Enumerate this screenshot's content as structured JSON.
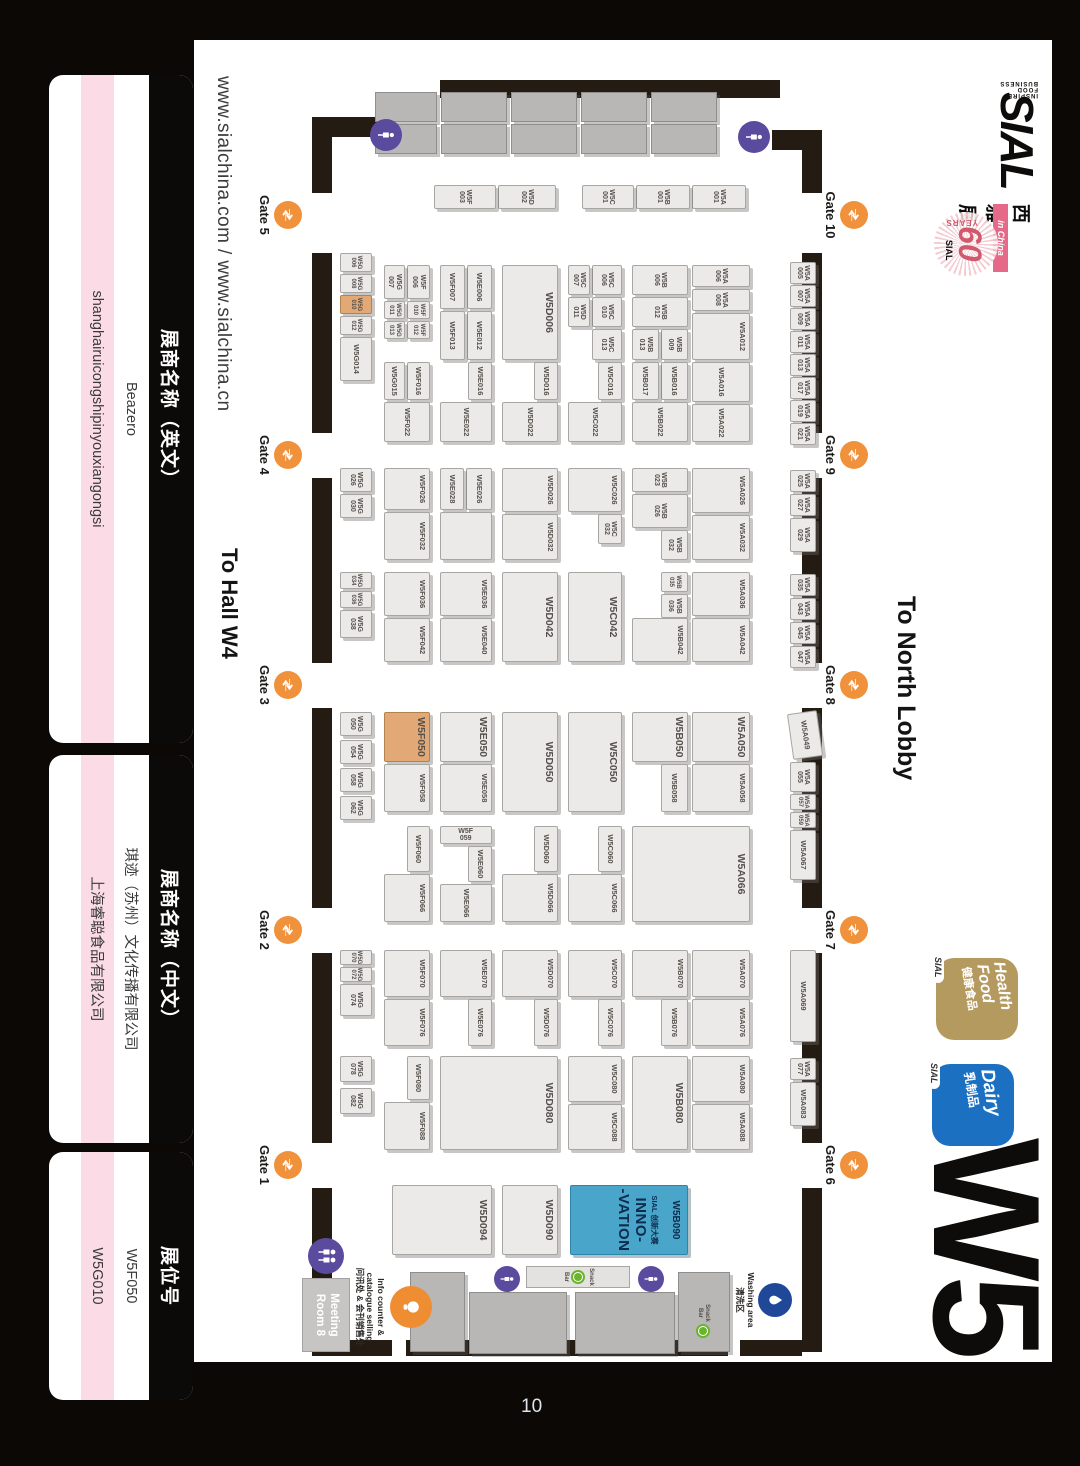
{
  "page": {
    "number": "10"
  },
  "header": {
    "urls": "www.sialchina.com / www.sialchina.cn",
    "to_hall": "To Hall W4",
    "to_lobby": "To North Lobby",
    "hall_id": "W5"
  },
  "logo": {
    "word": "SIAL",
    "tagline": "INSPIRE FOOD BUSINESS",
    "cn": "西雅展",
    "in_china": "in China",
    "anniv_number": "60",
    "anniv_years": "YEARS",
    "anniv_sial": "SIAL"
  },
  "badges": [
    {
      "name": "health-food",
      "line1": "Health",
      "line2": "Food",
      "cn": "健康食品",
      "tab": "SIAL",
      "color": "#b59a60"
    },
    {
      "name": "dairy",
      "line1": "Dairy",
      "line2": "",
      "cn": "乳制品",
      "tab": "SIAL",
      "color": "#1c70c2"
    }
  ],
  "table": {
    "headers": [
      "展商名称（英文）",
      "展商名称（中文）",
      "展位号"
    ],
    "rows": [
      [
        "Beazero",
        "琪迹（苏州）文化传播有限公司",
        "W5F050"
      ],
      [
        "shanghairuicongshipinyouxiangongsi",
        "上海睿聪食品有限公司",
        "W5G010"
      ]
    ],
    "highlight_color": "#fbdce6"
  },
  "map": {
    "highlighted_booths": [
      "W5F050",
      "W5G010"
    ],
    "gates_top": [
      {
        "label": "Gate 10",
        "x": 215
      },
      {
        "label": "Gate 9",
        "x": 455
      },
      {
        "label": "Gate 8",
        "x": 685
      },
      {
        "label": "Gate 7",
        "x": 930
      },
      {
        "label": "Gate 6",
        "x": 1165
      }
    ],
    "gates_bottom": [
      {
        "label": "Gate 5",
        "x": 215
      },
      {
        "label": "Gate 4",
        "x": 455
      },
      {
        "label": "Gate 3",
        "x": 685
      },
      {
        "label": "Gate 2",
        "x": 930
      },
      {
        "label": "Gate 1",
        "x": 1165
      }
    ],
    "walls": [
      [
        130,
        258,
        63,
        20
      ],
      [
        253,
        258,
        180,
        20
      ],
      [
        478,
        258,
        185,
        20
      ],
      [
        708,
        258,
        200,
        20
      ],
      [
        953,
        258,
        190,
        20
      ],
      [
        1188,
        258,
        164,
        20
      ],
      [
        117,
        748,
        76,
        20
      ],
      [
        253,
        748,
        180,
        20
      ],
      [
        478,
        748,
        185,
        20
      ],
      [
        708,
        748,
        200,
        20
      ],
      [
        953,
        748,
        190,
        20
      ],
      [
        1188,
        748,
        164,
        20
      ],
      [
        80,
        300,
        18,
        340
      ],
      [
        130,
        258,
        20,
        50
      ],
      [
        117,
        700,
        20,
        55
      ],
      [
        1340,
        278,
        16,
        62
      ],
      [
        1340,
        352,
        16,
        322
      ],
      [
        1340,
        688,
        16,
        80
      ]
    ],
    "service_blocks": [
      [
        92,
        363,
        30,
        66
      ],
      [
        92,
        433,
        30,
        66
      ],
      [
        92,
        503,
        30,
        66
      ],
      [
        92,
        573,
        30,
        66
      ],
      [
        92,
        643,
        30,
        62
      ],
      [
        124,
        363,
        30,
        66
      ],
      [
        124,
        433,
        30,
        66
      ],
      [
        124,
        503,
        30,
        66
      ],
      [
        124,
        573,
        30,
        66
      ],
      [
        124,
        643,
        30,
        62
      ],
      [
        1292,
        405,
        62,
        100
      ],
      [
        1292,
        513,
        62,
        98
      ],
      [
        1272,
        615,
        80,
        55
      ],
      [
        1272,
        350,
        80,
        52
      ]
    ],
    "booths": [
      [
        "W5A001",
        185,
        334,
        24,
        54
      ],
      [
        "W5B001",
        185,
        390,
        24,
        54
      ],
      [
        "W5C001",
        185,
        446,
        24,
        52
      ],
      [
        "W5D002",
        185,
        524,
        24,
        58
      ],
      [
        "W5F003",
        185,
        584,
        24,
        62
      ],
      [
        "W5A005",
        262,
        264,
        22,
        26
      ],
      [
        "W5A007",
        285,
        264,
        22,
        26
      ],
      [
        "W5A009",
        308,
        264,
        22,
        26
      ],
      [
        "W5A011",
        331,
        264,
        22,
        26
      ],
      [
        "W5A013",
        354,
        264,
        22,
        26
      ],
      [
        "W5A017",
        377,
        264,
        22,
        26
      ],
      [
        "W5A019",
        400,
        264,
        22,
        26
      ],
      [
        "W5A021",
        423,
        264,
        22,
        26
      ],
      [
        "W5A025",
        470,
        264,
        22,
        26
      ],
      [
        "W5A027",
        494,
        264,
        22,
        26
      ],
      [
        "W5A029",
        518,
        264,
        34,
        26
      ],
      [
        "W5A035",
        574,
        264,
        22,
        26
      ],
      [
        "W5A043",
        598,
        264,
        22,
        26
      ],
      [
        "W5A045",
        622,
        264,
        22,
        26
      ],
      [
        "W5A047",
        646,
        264,
        22,
        26
      ],
      [
        "W5A049",
        712,
        260,
        46,
        30,
        "r"
      ],
      [
        "W5A055",
        762,
        264,
        30,
        26
      ],
      [
        "W5A057",
        794,
        264,
        16,
        26
      ],
      [
        "W5A059",
        812,
        264,
        16,
        26
      ],
      [
        "W5A067",
        830,
        264,
        50,
        26
      ],
      [
        "W5A069",
        950,
        264,
        92,
        26
      ],
      [
        "W5A077",
        1058,
        264,
        22,
        26
      ],
      [
        "W5A083",
        1082,
        264,
        44,
        26
      ],
      [
        "W5A006",
        265,
        330,
        22,
        58
      ],
      [
        "W5A008",
        289,
        330,
        22,
        58
      ],
      [
        "W5A012",
        313,
        330,
        47,
        58
      ],
      [
        "W5A016",
        362,
        330,
        40,
        58
      ],
      [
        "W5A022",
        404,
        330,
        38,
        58
      ],
      [
        "W5A026",
        468,
        330,
        45,
        58
      ],
      [
        "W5A032",
        515,
        330,
        45,
        58
      ],
      [
        "W5A036",
        572,
        330,
        44,
        58
      ],
      [
        "W5A042",
        618,
        330,
        44,
        58
      ],
      [
        "W5A050",
        712,
        330,
        50,
        58
      ],
      [
        "W5A058",
        764,
        330,
        48,
        58
      ],
      [
        "W5A066",
        826,
        330,
        96,
        118
      ],
      [
        "W5A070",
        950,
        330,
        47,
        58
      ],
      [
        "W5A076",
        999,
        330,
        47,
        58
      ],
      [
        "W5A080",
        1056,
        330,
        46,
        58
      ],
      [
        "W5A088",
        1104,
        330,
        46,
        58
      ],
      [
        "W5B006",
        265,
        392,
        30,
        56
      ],
      [
        "W5B012",
        297,
        392,
        30,
        56
      ],
      [
        "W5B009",
        329,
        392,
        31,
        27
      ],
      [
        "W5B013",
        329,
        421,
        31,
        27
      ],
      [
        "W5B016",
        362,
        392,
        38,
        27
      ],
      [
        "W5B017",
        362,
        421,
        38,
        27
      ],
      [
        "W5B022",
        402,
        392,
        40,
        56
      ],
      [
        "W5B023",
        468,
        392,
        24,
        56
      ],
      [
        "W5B026",
        494,
        392,
        34,
        56
      ],
      [
        "W5B032",
        530,
        392,
        30,
        27
      ],
      [
        "W5B035",
        572,
        392,
        20,
        27
      ],
      [
        "W5B036",
        594,
        392,
        24,
        27
      ],
      [
        "W5B042",
        618,
        392,
        44,
        56
      ],
      [
        "W5B050",
        712,
        392,
        50,
        56
      ],
      [
        "W5B058",
        764,
        392,
        48,
        27
      ],
      [
        "W5B070",
        950,
        392,
        47,
        56
      ],
      [
        "W5B076",
        999,
        392,
        47,
        27
      ],
      [
        "W5B080",
        1056,
        392,
        94,
        56
      ],
      [
        "W5C006",
        265,
        458,
        30,
        30
      ],
      [
        "W5C007",
        265,
        490,
        30,
        22
      ],
      [
        "W5C010",
        297,
        458,
        30,
        30
      ],
      [
        "W5D011",
        297,
        490,
        30,
        22
      ],
      [
        "W5C013",
        329,
        458,
        31,
        30
      ],
      [
        "W5C016",
        362,
        458,
        38,
        24
      ],
      [
        "W5C022",
        402,
        458,
        40,
        54
      ],
      [
        "W5C026",
        468,
        458,
        44,
        54
      ],
      [
        "W5C032",
        514,
        458,
        30,
        24
      ],
      [
        "W5C042",
        572,
        458,
        90,
        54
      ],
      [
        "W5C050",
        712,
        458,
        100,
        54
      ],
      [
        "W5C060",
        826,
        458,
        46,
        24
      ],
      [
        "W5C066",
        874,
        458,
        48,
        54
      ],
      [
        "W5C070",
        950,
        458,
        47,
        54
      ],
      [
        "W5C076",
        999,
        458,
        47,
        24
      ],
      [
        "W5C080",
        1056,
        458,
        46,
        54
      ],
      [
        "W5C088",
        1104,
        458,
        46,
        54
      ],
      [
        "W5D006",
        265,
        522,
        95,
        56
      ],
      [
        "W5D016",
        362,
        522,
        38,
        24
      ],
      [
        "W5D022",
        402,
        522,
        40,
        56
      ],
      [
        "W5D026",
        468,
        522,
        44,
        56
      ],
      [
        "W5D032",
        514,
        522,
        46,
        56
      ],
      [
        "W5D042",
        572,
        522,
        90,
        56
      ],
      [
        "W5D050",
        712,
        522,
        100,
        56
      ],
      [
        "W5D060",
        826,
        522,
        46,
        24
      ],
      [
        "W5D066",
        874,
        522,
        48,
        56
      ],
      [
        "W5D070",
        950,
        522,
        47,
        56
      ],
      [
        "W5D076",
        999,
        522,
        47,
        24
      ],
      [
        "W5D080",
        1056,
        522,
        94,
        118
      ],
      [
        "W5D090",
        1185,
        522,
        70,
        56
      ],
      [
        "W5E006",
        265,
        588,
        44,
        25
      ],
      [
        "W5F007",
        265,
        615,
        44,
        25
      ],
      [
        "W5E012",
        311,
        588,
        49,
        25
      ],
      [
        "W5F013",
        311,
        615,
        49,
        25
      ],
      [
        "W5E016",
        362,
        588,
        38,
        24
      ],
      [
        "W5E022",
        402,
        588,
        40,
        52
      ],
      [
        "W5E026",
        468,
        588,
        42,
        26
      ],
      [
        "W5E028",
        468,
        616,
        42,
        24
      ],
      [
        "",
        512,
        588,
        48,
        52,
        "b"
      ],
      [
        "W5E036",
        572,
        588,
        44,
        52
      ],
      [
        "W5E040",
        618,
        588,
        44,
        52
      ],
      [
        "W5E050",
        712,
        588,
        50,
        52
      ],
      [
        "W5E058",
        764,
        588,
        48,
        52
      ],
      [
        "W5F059",
        826,
        588,
        18,
        52,
        "v"
      ],
      [
        "W5E060",
        846,
        588,
        36,
        24
      ],
      [
        "W5E066",
        884,
        588,
        38,
        52
      ],
      [
        "W5E070",
        950,
        588,
        47,
        52
      ],
      [
        "W5E076",
        999,
        588,
        47,
        24
      ],
      [
        "W5D094",
        1185,
        588,
        70,
        100
      ],
      [
        "W5F006",
        265,
        650,
        34,
        23
      ],
      [
        "W5G007",
        265,
        675,
        34,
        21
      ],
      [
        "W5F010",
        301,
        650,
        18,
        23
      ],
      [
        "W5F012",
        321,
        650,
        18,
        23
      ],
      [
        "W5G011",
        301,
        675,
        18,
        21
      ],
      [
        "W5G013",
        321,
        675,
        18,
        21
      ],
      [
        "W5F016",
        362,
        650,
        38,
        23
      ],
      [
        "W5G015",
        362,
        675,
        38,
        21
      ],
      [
        "W5F022",
        402,
        650,
        40,
        46
      ],
      [
        "W5F026",
        468,
        650,
        42,
        46
      ],
      [
        "W5F032",
        512,
        650,
        48,
        46
      ],
      [
        "W5F036",
        572,
        650,
        44,
        46
      ],
      [
        "W5F042",
        618,
        650,
        44,
        46
      ],
      [
        "W5F050",
        712,
        650,
        50,
        46,
        "hl"
      ],
      [
        "W5F058",
        764,
        650,
        48,
        46
      ],
      [
        "W5F060",
        826,
        650,
        46,
        23
      ],
      [
        "W5F066",
        874,
        650,
        48,
        46
      ],
      [
        "W5F070",
        950,
        650,
        47,
        46
      ],
      [
        "W5F076",
        999,
        650,
        47,
        46
      ],
      [
        "W5F080",
        1056,
        650,
        44,
        23
      ],
      [
        "W5F088",
        1102,
        650,
        48,
        46
      ],
      [
        "W5G006",
        253,
        708,
        19,
        32
      ],
      [
        "W5G008",
        274,
        708,
        19,
        32
      ],
      [
        "W5G010",
        295,
        708,
        19,
        32,
        "hl"
      ],
      [
        "W5G012",
        316,
        708,
        19,
        32
      ],
      [
        "W5G014",
        337,
        708,
        44,
        32
      ],
      [
        "W5G026",
        468,
        708,
        24,
        32
      ],
      [
        "W5G030",
        494,
        708,
        24,
        32
      ],
      [
        "W5G034",
        572,
        708,
        17,
        32
      ],
      [
        "W5G036",
        591,
        708,
        17,
        32
      ],
      [
        "W5G038",
        610,
        708,
        28,
        32
      ],
      [
        "W5G050",
        712,
        708,
        24,
        32
      ],
      [
        "W5G054",
        740,
        708,
        24,
        32
      ],
      [
        "W5G058",
        768,
        708,
        24,
        32
      ],
      [
        "W5G062",
        796,
        708,
        24,
        32
      ],
      [
        "W5G070",
        950,
        708,
        15,
        32
      ],
      [
        "W5G072",
        967,
        708,
        15,
        32
      ],
      [
        "W5G074",
        984,
        708,
        32,
        32
      ],
      [
        "W5G078",
        1056,
        708,
        26,
        32
      ],
      [
        "W5G082",
        1088,
        708,
        26,
        32
      ]
    ],
    "innovation": {
      "booth": "W5B090",
      "brand": "SIAL",
      "cn": "创新大赛",
      "line1": "INNO-",
      "line2": "-VATION"
    },
    "facilities": {
      "meeting_room": "Meeting Room 8",
      "info_line1": "Info counter &",
      "info_line2": "catalogue selling",
      "info_line3": "问讯处 & 会刊销售处",
      "washing_en": "Washing area",
      "washing_cn": "清洗区",
      "snack_line1": "Snack",
      "snack_line2": "Bar"
    }
  }
}
